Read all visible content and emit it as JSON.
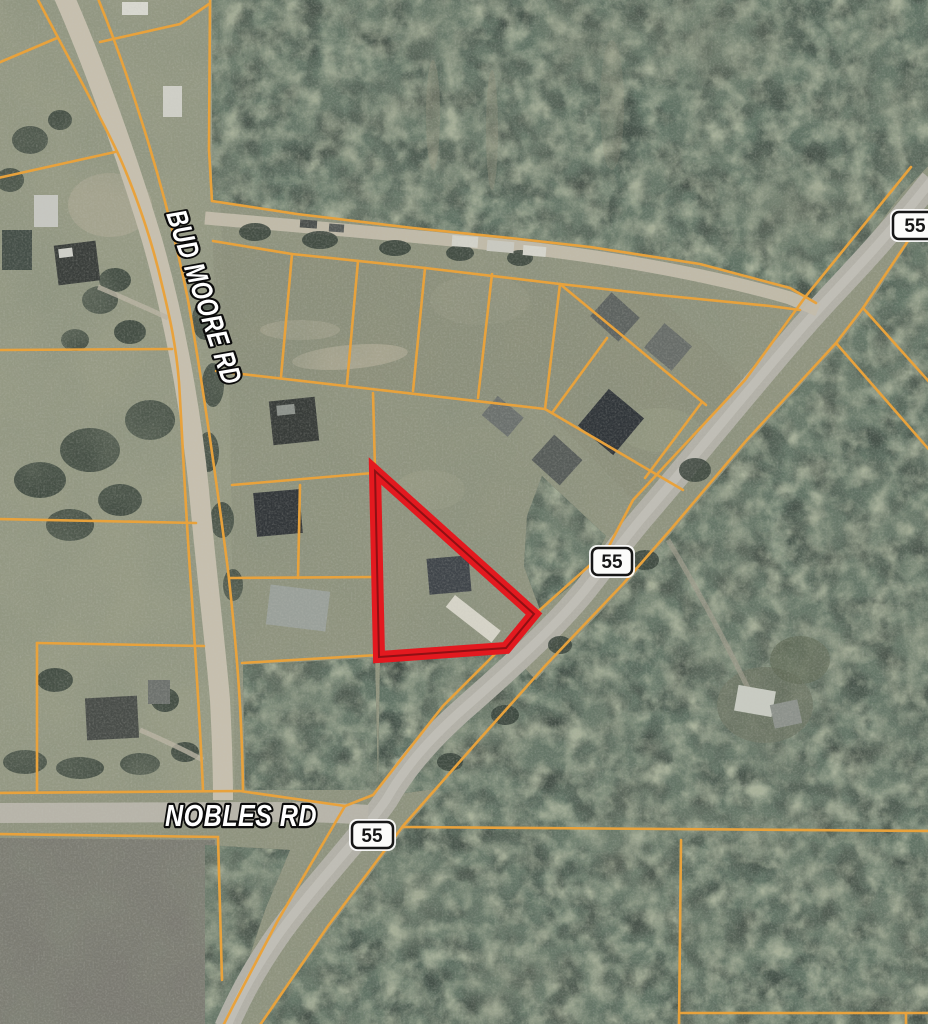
{
  "map": {
    "description": "Aerial parcel map with highlighted triangular lot at Highway 55",
    "road_labels": [
      {
        "id": "bud-moore-rd",
        "text": "BUD MOORE RD"
      },
      {
        "id": "nobles-rd",
        "text": "NOBLES RD"
      }
    ],
    "route_shields": [
      {
        "route": "55",
        "position": "top-right"
      },
      {
        "route": "55",
        "position": "center"
      },
      {
        "route": "55",
        "position": "bottom-center"
      }
    ],
    "highlighted_parcel": {
      "shape": "triangular parcel outline",
      "outline_color": "#e3191f"
    },
    "parcel_line_color": "#e8a23c"
  }
}
